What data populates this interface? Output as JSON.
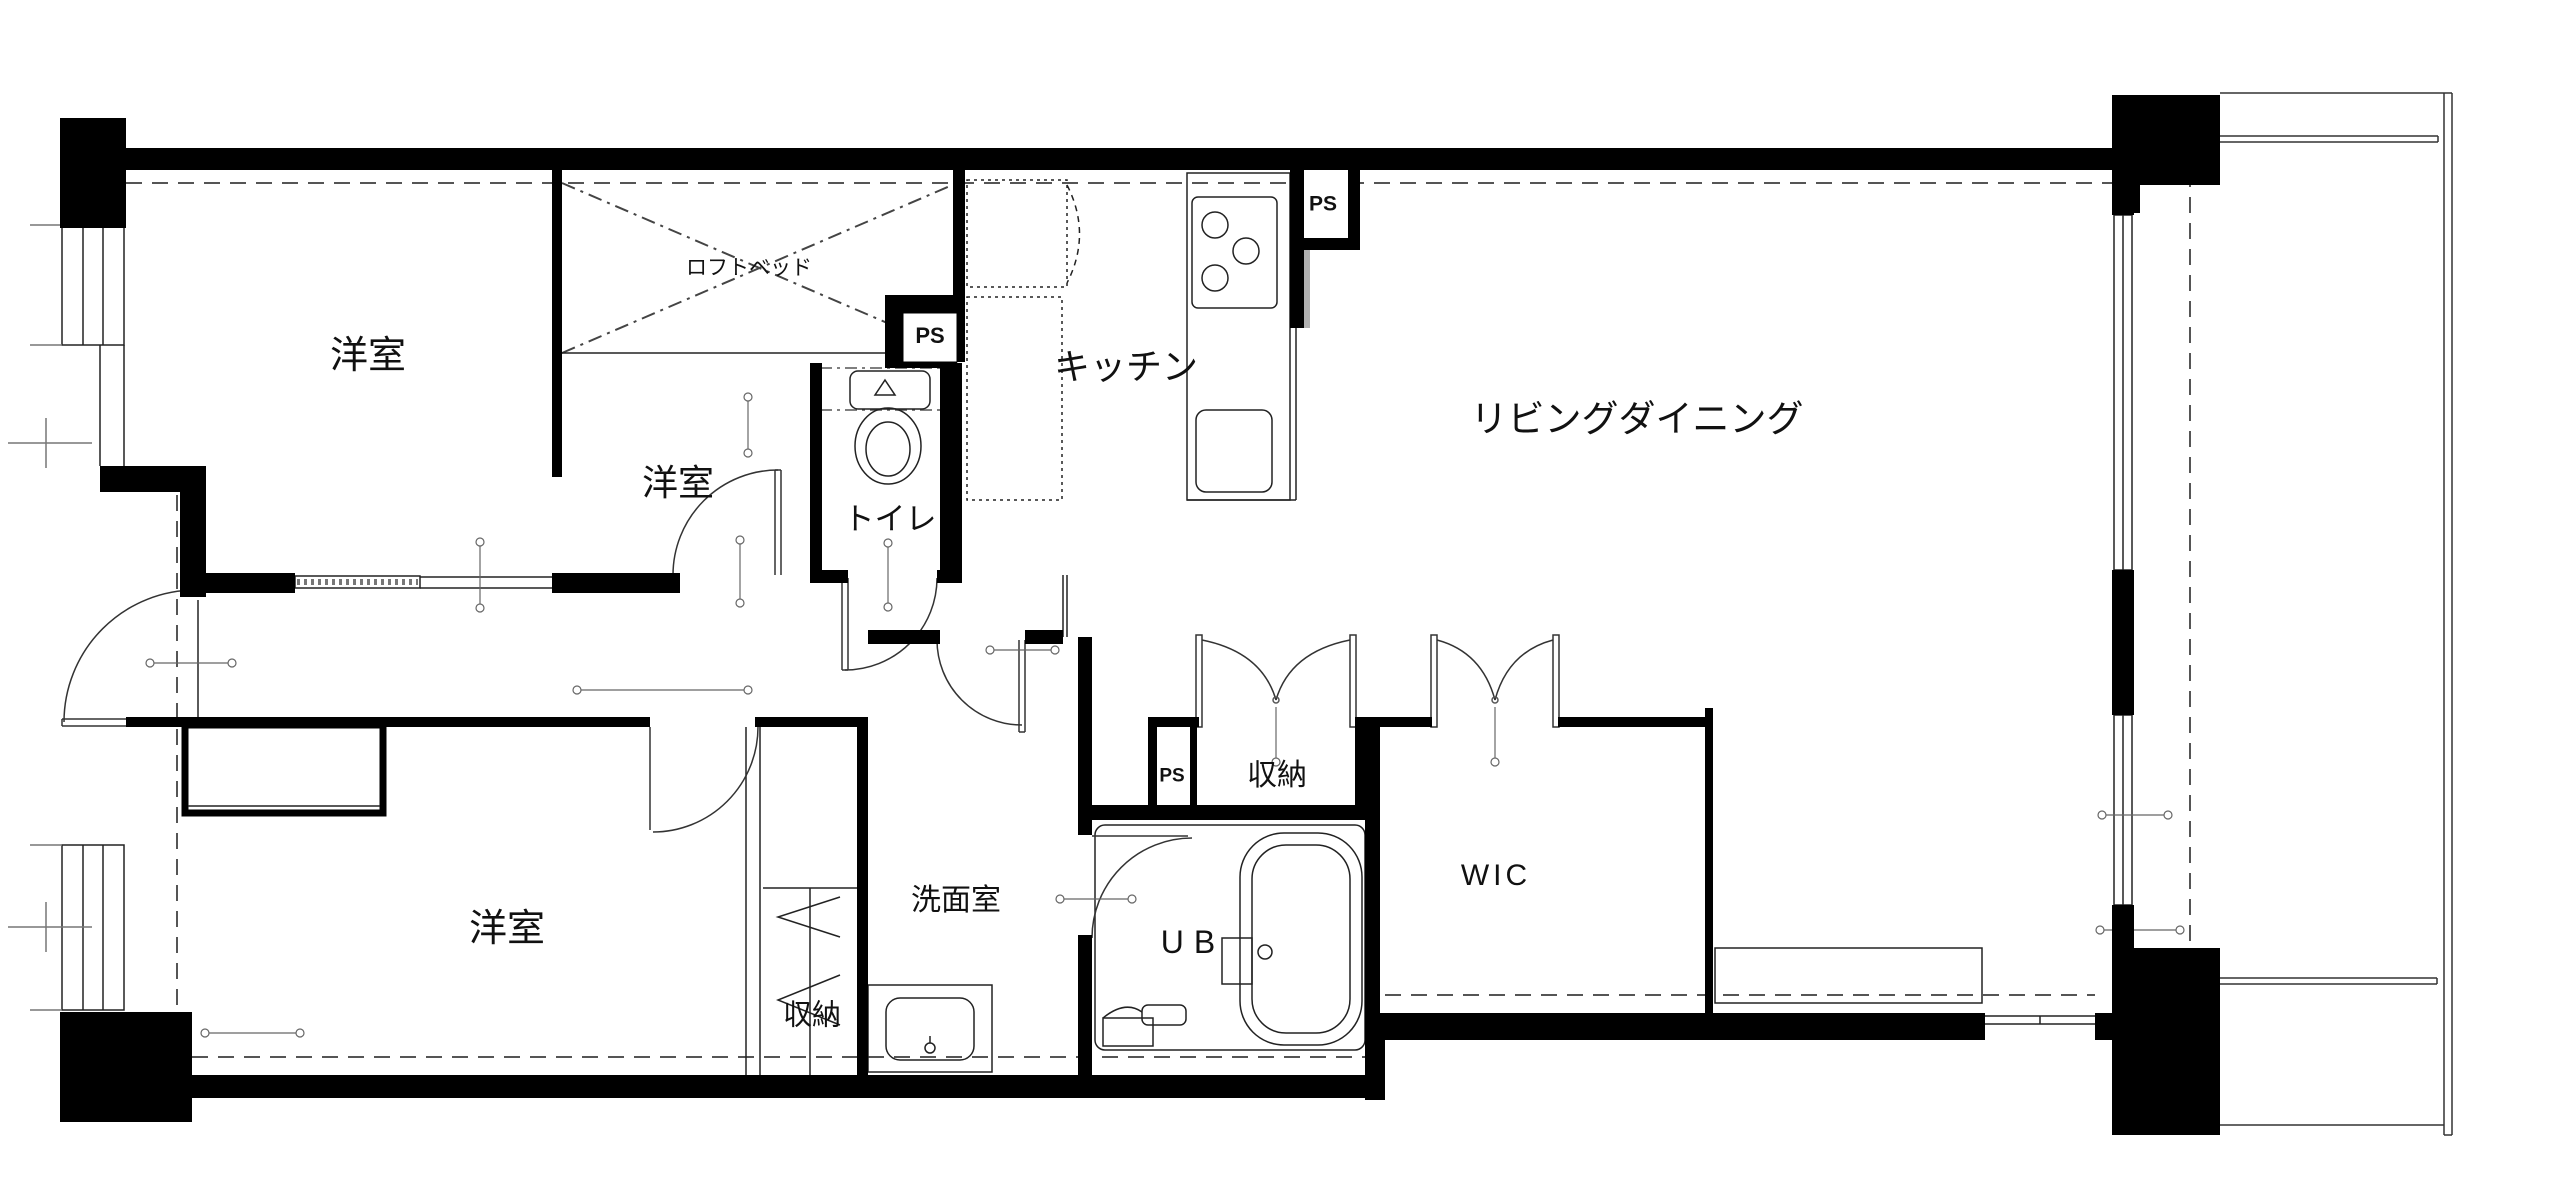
{
  "plan": {
    "colors": {
      "background": "#ffffff",
      "wall": "#000000",
      "line": "#1a1a1a",
      "dash": "#555555",
      "shadow": "#b0b0b0"
    },
    "rooms": [
      {
        "id": "bedroom-nw",
        "label": "洋室"
      },
      {
        "id": "loft-bed",
        "label": "ロフトベッド"
      },
      {
        "id": "bedroom-center",
        "label": "洋室"
      },
      {
        "id": "toilet",
        "label": "トイレ"
      },
      {
        "id": "kitchen",
        "label": "キッチン"
      },
      {
        "id": "living-dining",
        "label": "リビングダイニング"
      },
      {
        "id": "ps-toilet",
        "label": "PS"
      },
      {
        "id": "ps-kitchen",
        "label": "PS"
      },
      {
        "id": "ps-center",
        "label": "PS"
      },
      {
        "id": "storage-center",
        "label": "収納"
      },
      {
        "id": "wic",
        "label": "WIC"
      },
      {
        "id": "washroom",
        "label": "洗面室"
      },
      {
        "id": "unit-bath",
        "label": "UB"
      },
      {
        "id": "storage-south",
        "label": "収納"
      },
      {
        "id": "bedroom-sw",
        "label": "洋室"
      }
    ]
  }
}
